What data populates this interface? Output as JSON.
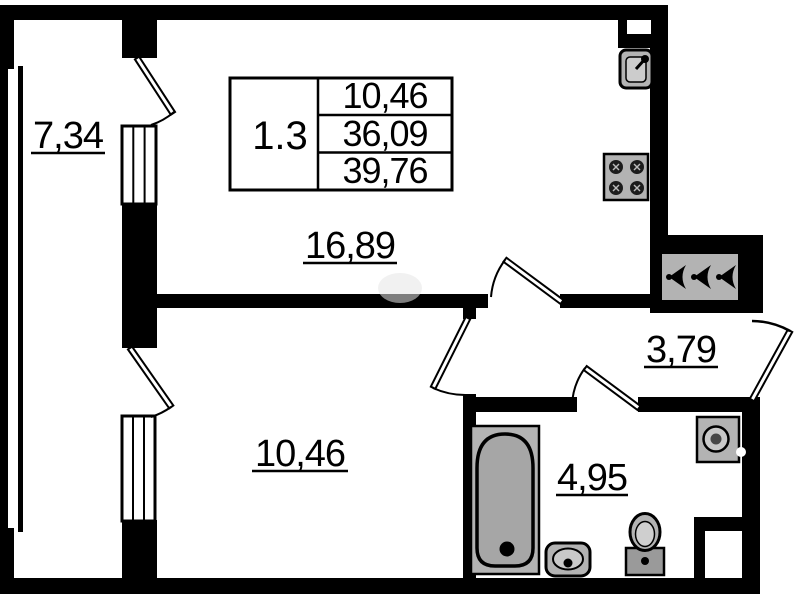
{
  "title_block": {
    "unit_number": "1.3",
    "rows": [
      "10,46",
      "36,09",
      "39,76"
    ]
  },
  "room_labels": {
    "balcony": "7,34",
    "living_room": "16,89",
    "bedroom": "10,46",
    "hallway": "3,79",
    "bathroom": "4,95"
  },
  "icons": {
    "fixtures": [
      "bathtub-icon",
      "wash-basin-icon",
      "toilet-icon",
      "washing-machine-icon",
      "kitchen-sink-icon",
      "stove-icon",
      "ventilation-grille-icon",
      "door-swing-icon",
      "window-icon"
    ]
  },
  "colors": {
    "wall": "#000000",
    "fixture_fill": "#b3b3b3",
    "background": "#ffffff"
  }
}
